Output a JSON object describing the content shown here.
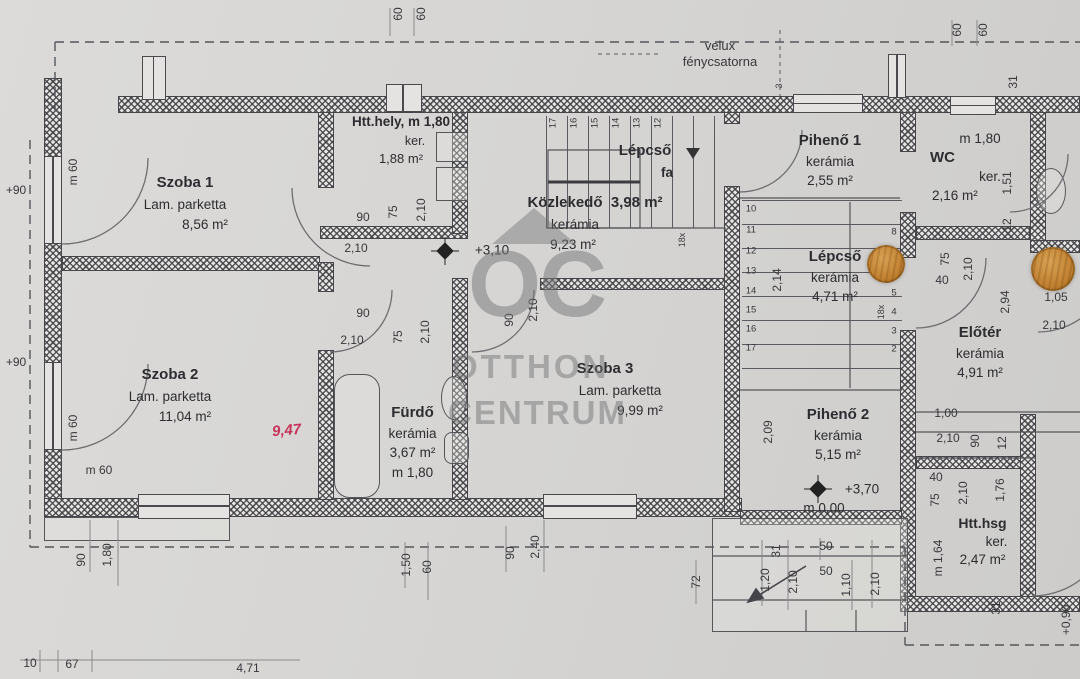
{
  "watermark": {
    "logo_text": "OC",
    "line1": "OTTHON",
    "line2": "CENTRUM"
  },
  "roof_note": {
    "line1": "velux",
    "line2": "fénycsatorna"
  },
  "rooms": {
    "szoba1": {
      "name": "Szoba 1",
      "floor": "Lam. parketta",
      "area": "8,56 m²"
    },
    "htthely": {
      "name": "Htt.hely, m 1,80",
      "floor": "ker.",
      "area": "1,88 m²"
    },
    "kozlekedo": {
      "name": "Közlekedő",
      "area_top": "3,98 m²",
      "floor": "kerámia",
      "area": "9,23 m²",
      "level": "+3,10"
    },
    "lepcso_fa": {
      "name": "Lépcső",
      "material": "fa"
    },
    "piheno1": {
      "name": "Pihenő 1",
      "floor": "kerámia",
      "area": "2,55 m²"
    },
    "wc": {
      "height": "m 1,80",
      "name": "WC",
      "floor": "ker.",
      "area": "2,16 m²"
    },
    "lepcso_keramia": {
      "name": "Lépcső",
      "floor": "kerámia",
      "area": "4,71 m²"
    },
    "eloter": {
      "name": "Előtér",
      "floor": "kerámia",
      "area": "4,91 m²"
    },
    "szoba2": {
      "name": "Szoba 2",
      "floor": "Lam. parketta",
      "area": "11,04 m²",
      "handwritten": "9,47"
    },
    "furdo": {
      "name": "Fürdő",
      "floor": "kerámia",
      "area": "3,67 m²",
      "height": "m 1,80"
    },
    "szoba3": {
      "name": "Szoba 3",
      "floor": "Lam. parketta",
      "area": "9,99 m²"
    },
    "piheno2": {
      "name": "Pihenő 2",
      "floor": "kerámia",
      "area": "5,15 m²",
      "level": "+3,70",
      "level_base": "m 0,00"
    },
    "htthsg": {
      "name": "Htt.hsg",
      "floor": "ker.",
      "area": "2,47 m²",
      "height": "m 1,64"
    }
  },
  "stairs": {
    "upper_numbers": [
      "17",
      "16",
      "15",
      "14",
      "13",
      "12"
    ],
    "lower_left_numbers": [
      "10",
      "11",
      "12",
      "13",
      "14",
      "15",
      "16",
      "17"
    ],
    "lower_right_numbers": [
      "8",
      "5",
      "4",
      "3",
      "2"
    ]
  },
  "colors": {
    "paper": "#d6d5d3",
    "ink": "#38383c",
    "red_note": "#c7335a",
    "hole": "#c08030"
  },
  "dims": [
    {
      "t": "60",
      "x": 398,
      "y": 14,
      "r": 90
    },
    {
      "t": "60",
      "x": 421,
      "y": 14,
      "r": 90
    },
    {
      "t": "60",
      "x": 957,
      "y": 30,
      "r": 90
    },
    {
      "t": "60",
      "x": 983,
      "y": 30,
      "r": 90
    },
    {
      "t": "3",
      "x": 779,
      "y": 86,
      "r": 90,
      "s": 1
    },
    {
      "t": "31",
      "x": 1013,
      "y": 82,
      "r": 90
    },
    {
      "t": "+90",
      "x": 16,
      "y": 190
    },
    {
      "t": "+90",
      "x": 16,
      "y": 362
    },
    {
      "t": "m 60",
      "x": 73,
      "y": 172,
      "r": 90
    },
    {
      "t": "m 60",
      "x": 73,
      "y": 428,
      "r": 90
    },
    {
      "t": "m 60",
      "x": 99,
      "y": 470
    },
    {
      "t": "90",
      "x": 363,
      "y": 217
    },
    {
      "t": "2,10",
      "x": 356,
      "y": 248
    },
    {
      "t": "75",
      "x": 393,
      "y": 212,
      "r": 90
    },
    {
      "t": "2,10",
      "x": 421,
      "y": 210,
      "r": 90
    },
    {
      "t": "90",
      "x": 363,
      "y": 313
    },
    {
      "t": "2,10",
      "x": 352,
      "y": 340
    },
    {
      "t": "75",
      "x": 398,
      "y": 337,
      "r": 90
    },
    {
      "t": "2,10",
      "x": 425,
      "y": 332,
      "r": 90
    },
    {
      "t": "90",
      "x": 509,
      "y": 320,
      "r": 90
    },
    {
      "t": "2,10",
      "x": 533,
      "y": 310,
      "r": 90
    },
    {
      "t": "2,14",
      "x": 777,
      "y": 280,
      "r": 90
    },
    {
      "t": "18x",
      "x": 682,
      "y": 240,
      "r": 90,
      "s": 1
    },
    {
      "t": "18x",
      "x": 881,
      "y": 312,
      "r": 90,
      "s": 1
    },
    {
      "t": "2,09",
      "x": 768,
      "y": 432,
      "r": 90
    },
    {
      "t": "1,00",
      "x": 946,
      "y": 413
    },
    {
      "t": "2,10",
      "x": 948,
      "y": 438
    },
    {
      "t": "40",
      "x": 936,
      "y": 477
    },
    {
      "t": "75",
      "x": 935,
      "y": 500,
      "r": 90
    },
    {
      "t": "90",
      "x": 975,
      "y": 441,
      "r": 90
    },
    {
      "t": "12",
      "x": 1002,
      "y": 443,
      "r": 90
    },
    {
      "t": "2,10",
      "x": 963,
      "y": 493,
      "r": 90
    },
    {
      "t": "1,76",
      "x": 1000,
      "y": 490,
      "r": 90
    },
    {
      "t": "m 1,64",
      "x": 938,
      "y": 558,
      "r": 90
    },
    {
      "t": "75",
      "x": 945,
      "y": 259,
      "r": 90
    },
    {
      "t": "40",
      "x": 942,
      "y": 280
    },
    {
      "t": "2,10",
      "x": 968,
      "y": 269,
      "r": 90
    },
    {
      "t": "2,94",
      "x": 1005,
      "y": 302,
      "r": 90
    },
    {
      "t": "1,05",
      "x": 1056,
      "y": 297
    },
    {
      "t": "2,10",
      "x": 1054,
      "y": 325
    },
    {
      "t": "1,51",
      "x": 1007,
      "y": 183,
      "r": 90
    },
    {
      "t": "12",
      "x": 1007,
      "y": 225,
      "r": 90
    },
    {
      "t": "90",
      "x": 81,
      "y": 560,
      "r": 90
    },
    {
      "t": "1,80",
      "x": 107,
      "y": 555,
      "r": 90
    },
    {
      "t": "1,50",
      "x": 406,
      "y": 565,
      "r": 90
    },
    {
      "t": "60",
      "x": 427,
      "y": 567,
      "r": 90
    },
    {
      "t": "90",
      "x": 510,
      "y": 553,
      "r": 90
    },
    {
      "t": "2,40",
      "x": 535,
      "y": 547,
      "r": 90
    },
    {
      "t": "72",
      "x": 696,
      "y": 582,
      "r": 90
    },
    {
      "t": "1,20",
      "x": 765,
      "y": 580,
      "r": 90
    },
    {
      "t": "31",
      "x": 776,
      "y": 551,
      "r": 90
    },
    {
      "t": "2,10",
      "x": 793,
      "y": 582,
      "r": 90
    },
    {
      "t": "50",
      "x": 826,
      "y": 546
    },
    {
      "t": "50",
      "x": 826,
      "y": 571
    },
    {
      "t": "1,10",
      "x": 846,
      "y": 585,
      "r": 90
    },
    {
      "t": "2,10",
      "x": 875,
      "y": 584,
      "r": 90
    },
    {
      "t": "31",
      "x": 996,
      "y": 608,
      "r": 90
    },
    {
      "t": "+0,90",
      "x": 1066,
      "y": 620,
      "r": 90
    },
    {
      "t": "10",
      "x": 30,
      "y": 663
    },
    {
      "t": "67",
      "x": 72,
      "y": 664
    },
    {
      "t": "4,71",
      "x": 248,
      "y": 668
    }
  ]
}
